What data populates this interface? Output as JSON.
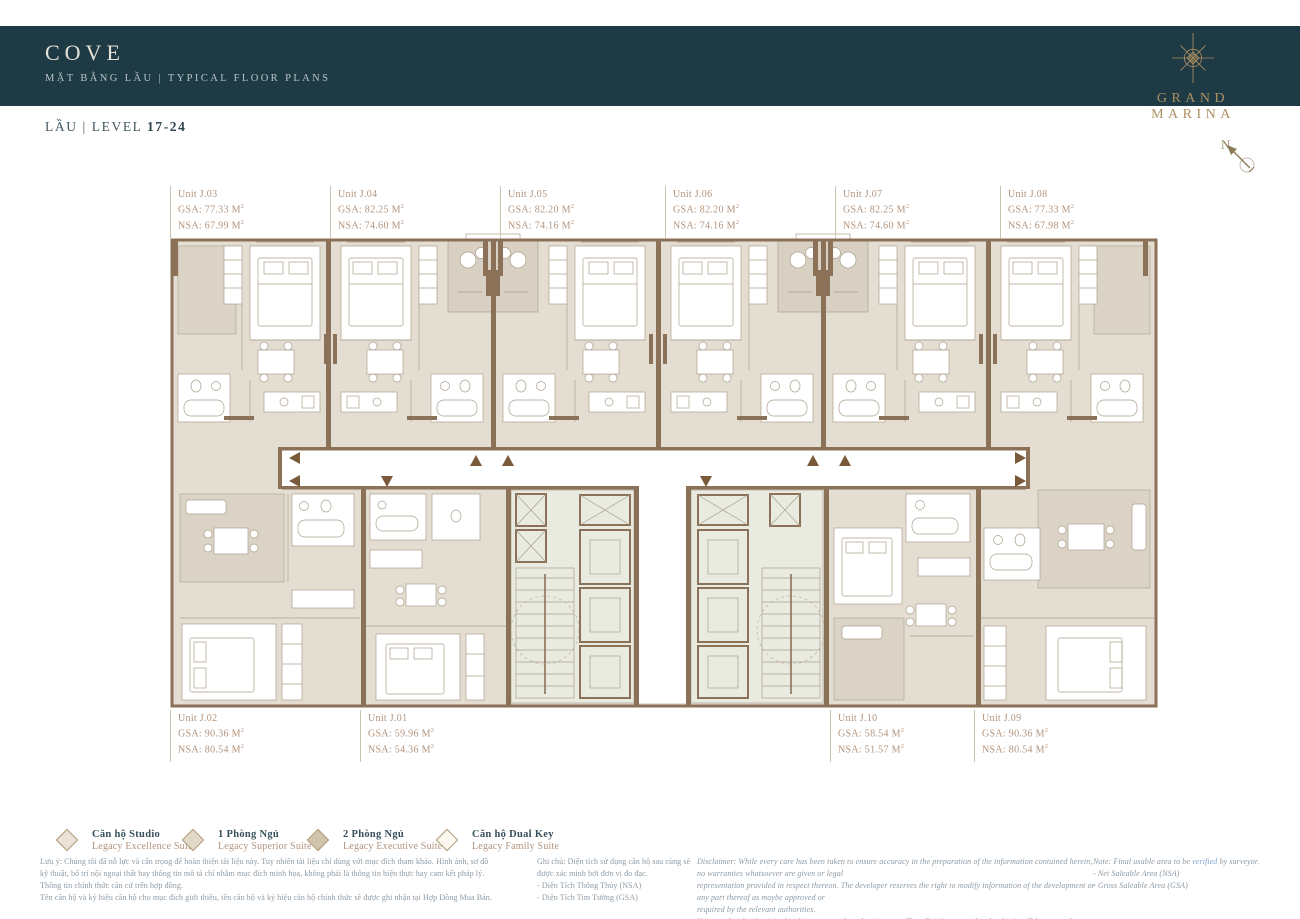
{
  "header": {
    "title": "COVE",
    "subtitle": "MẶT BẰNG LẦU  |  TYPICAL FLOOR PLANS",
    "brand": "GRAND MARINA"
  },
  "level": {
    "prefix": "LẦU | LEVEL",
    "range": "17-24"
  },
  "north_label": "N",
  "plan": {
    "area_labels": {
      "gsa": "GSA:",
      "nsa": "NSA:",
      "unit_suffix": "M",
      "sup": "2"
    },
    "units": [
      {
        "id": "j03",
        "name": "Unit J.03",
        "gsa": "77.33",
        "nsa": "67.99"
      },
      {
        "id": "j04",
        "name": "Unit J.04",
        "gsa": "82.25",
        "nsa": "74.60"
      },
      {
        "id": "j05",
        "name": "Unit J.05",
        "gsa": "82.20",
        "nsa": "74.16"
      },
      {
        "id": "j06",
        "name": "Unit J.06",
        "gsa": "82.20",
        "nsa": "74.16"
      },
      {
        "id": "j07",
        "name": "Unit J.07",
        "gsa": "82.25",
        "nsa": "74.60"
      },
      {
        "id": "j08",
        "name": "Unit J.08",
        "gsa": "77.33",
        "nsa": "67.98"
      },
      {
        "id": "j02",
        "name": "Unit J.02",
        "gsa": "90.36",
        "nsa": "80.54"
      },
      {
        "id": "j01",
        "name": "Unit J.01",
        "gsa": "59.96",
        "nsa": "54.36"
      },
      {
        "id": "j10",
        "name": "Unit J.10",
        "gsa": "58.54",
        "nsa": "51.57"
      },
      {
        "id": "j09",
        "name": "Unit J.09",
        "gsa": "90.36",
        "nsa": "80.54"
      }
    ]
  },
  "legend": {
    "diamond_stroke": "#b19c79",
    "items": [
      {
        "vi": "Căn hộ Studio",
        "en": "Legacy Excellence Suite",
        "fill": "#eae3d6"
      },
      {
        "vi": "1 Phòng Ngủ",
        "en": "Legacy Superior Suite",
        "fill": "#e3d9c7"
      },
      {
        "vi": "2 Phòng Ngủ",
        "en": "Legacy Executive Suite",
        "fill": "#d2c4aa"
      },
      {
        "vi": "Căn hộ Dual Key",
        "en": "Legacy Family Suite",
        "fill": "#faf7f1"
      }
    ]
  },
  "footer": {
    "note_vi_lines": [
      "Lưu ý: Chúng tôi đã nỗ lực và cẩn trọng để hoàn thiện tài liệu này. Tuy nhiên tài liệu chỉ dùng với mục đích tham khảo. Hình ảnh, sơ đồ",
      "kỹ thuật, bố trí nội ngoại thất hay thông tin mô tả chỉ nhằm mục đích minh họa, không phải là thông tin hiện thực hay cam kết pháp lý.",
      "Thông tin chính thức căn cứ trên hợp đồng.",
      "Tên căn hộ và ký hiệu căn hộ cho mục đích giới thiệu, tên căn hộ và ký hiệu căn hộ chính thức sẽ được ghi nhận tại Hợp Đồng Mua Bán."
    ],
    "ghichu_lines": [
      "Ghi chú: Diện tích sử dụng căn hộ sau cùng sẽ được xác minh bởi đơn vị đo đạc.",
      "- Diện Tích Thông Thủy (NSA)",
      "- Diện Tích Tim Tường (GSA)"
    ],
    "disclaimer_lines": [
      "Disclaimer: While every care has been taken to ensure accuracy in the preparation of the information contained herein, no warranties whatsoever are given or legal",
      "representation provided in respect thereon. The developer reserves the right to modify information of the development or any part thereof as maybe approved or",
      "required by the relevant authorities.",
      "Name and code of unit in this document are for advertisement. The official name and code of unit will be as per the Sales and Purchase Agreement."
    ],
    "note_en": {
      "prefix": "Note: Final usable area to be ",
      "highlight": "verified",
      "suffix": " by surveyor.",
      "lines": [
        "- Net Saleable Area (NSA)",
        "- Gross Saleable Area (GSA)"
      ]
    }
  },
  "colors": {
    "header_bg": "#1e3a45",
    "gold": "#a98c5e",
    "label_tan": "#b2937c",
    "wall_brown": "#8b7157",
    "room_beige": "#e4ddd1",
    "core_green": "#e9ebe1"
  }
}
